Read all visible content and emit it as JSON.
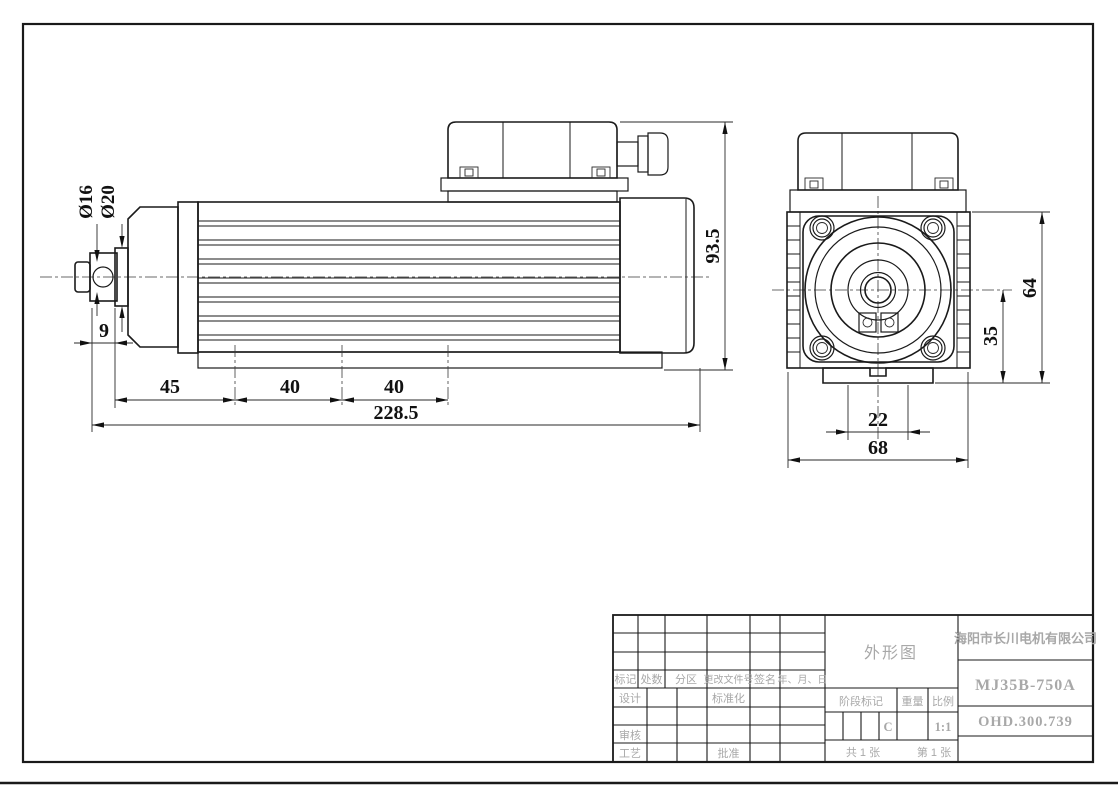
{
  "drawing": {
    "kind": "motor-outline-drawing"
  },
  "dimensions": {
    "side": {
      "shaft_dia_inner": "Ø16",
      "shaft_dia_outer": "Ø20",
      "shaft_protrusion": "9",
      "segment_front": "45",
      "segment_mid1": "40",
      "segment_mid2": "40",
      "overall_length": "228.5",
      "overall_height": "93.5"
    },
    "front": {
      "flange_height": "64",
      "center_to_base": "35",
      "slot_width": "22",
      "body_width": "68"
    }
  },
  "title_block": {
    "drawing_title": "外形图",
    "company": "海阳市长川电机有限公司",
    "model": "MJ35B-750A",
    "drawing_number": "OHD.300.739",
    "stage_mark_label": "阶段标记",
    "stage_mark_value": "C",
    "weight_label": "重量",
    "scale_label": "比例",
    "scale_value": "1:1",
    "sheet_total": "共 1 张",
    "sheet_current": "第 1 张",
    "revision": {
      "mark": "标记",
      "count": "处数",
      "zone": "分区",
      "change_doc_no": "更改文件号",
      "signature": "签名",
      "date": "年、月、日"
    },
    "roles": {
      "design": "设计",
      "standardization": "标准化",
      "review": "审核",
      "process": "工艺",
      "approve": "批准"
    }
  }
}
